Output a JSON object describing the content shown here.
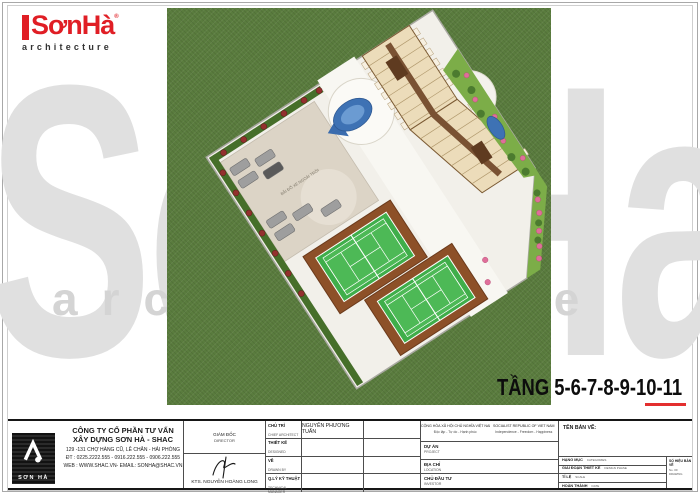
{
  "page": {
    "floor_label": "TẦNG 5-6-7-8-9-10-11"
  },
  "logo": {
    "brand": "SơnHà",
    "registered_mark": "®",
    "tagline": "architecture"
  },
  "watermark": {
    "brand": "SonHa",
    "tagline": "architecture"
  },
  "site_plan": {
    "parking_label": "BÃI ĐỖ XE NGOÀI TRỜI",
    "colors": {
      "grass": "#5a7c3e",
      "pavement": "#f2f0ea",
      "parking": "#dcd4c6",
      "court_green": "#3fae4a",
      "court_border_brown": "#8d5028",
      "building_beige": "#ecdcba",
      "corridor_brown": "#7a5233",
      "pool_blue": "#3e72b4",
      "hedge_green": "#466f2a",
      "flower_red": "#93302e",
      "flower_pink": "#df6f9a",
      "accent_red": "#e32f2f"
    }
  },
  "title_block": {
    "company": {
      "logo_text": "SƠN HÀ",
      "name_line1": "CÔNG TY CỔ PHẦN TƯ VẤN",
      "name_line2": "XÂY DỰNG SƠN HÀ - SHAC",
      "address": "129 -131 CHỢ HÀNG CŨ, LÊ CHÂN - HẢI PHÒNG",
      "phone": "ĐT : 0225.2222.555 - 0916.222.555 - 0906.222.555",
      "web": "WEB : WWW.SHAC.VN- EMAIL: SONHA@SHAC.VN"
    },
    "director": {
      "label_vi": "GIÁM ĐỐC",
      "label_en": "DIRECTOR",
      "name": "KTS. NGUYỄN HOÀNG LONG"
    },
    "staff_rows": [
      {
        "label_vi": "CHỦ TRÌ",
        "label_en": "CHIEF ARCHITECT",
        "value": "NGUYỄN PHƯƠNG TUẤN"
      },
      {
        "label_vi": "THIẾT KẾ",
        "label_en": "DESIGNED",
        "value": ""
      },
      {
        "label_vi": "VẼ",
        "label_en": "DRAWN BY",
        "value": ""
      },
      {
        "label_vi": "Q.LÝ KỸ THUẬT",
        "label_en": "TECHNICAL MANAGER",
        "value": ""
      }
    ],
    "republic": {
      "line1_vi": "CỘNG HÒA XÃ HỘI CHỦ NGHĨA VIỆT NAM",
      "line2_vi": "Độc lập - Tự do - Hạnh phúc",
      "line1_en": "SOCIALIST REPUBLIC OF VIET NAM",
      "line2_en": "Independence - Freedom - Happiness"
    },
    "project_rows": [
      {
        "label_vi": "DỰ ÁN",
        "label_en": "PROJECT"
      },
      {
        "label_vi": "ĐỊA CHỈ",
        "label_en": "LOCATION"
      },
      {
        "label_vi": "CHỦ ĐẦU TƯ",
        "label_en": "INVESTOR"
      }
    ],
    "drawing": {
      "title_label": "TÊN BẢN VẼ:",
      "rows": [
        {
          "label_vi": "HẠNG MỤC",
          "label_en": "CATEGORIES"
        },
        {
          "label_vi": "GIAI ĐOẠN THIẾT KẾ",
          "label_en": "DESIGN PHASE"
        },
        {
          "label_vi": "TỈ LỆ",
          "label_en": "SCALE"
        },
        {
          "label_vi": "HOÀN THÀNH",
          "label_en": "DATE"
        }
      ],
      "number_label_vi": "SỐ HIỆU BẢN VẼ",
      "number_label_en": "No. OF DRAWING"
    }
  }
}
